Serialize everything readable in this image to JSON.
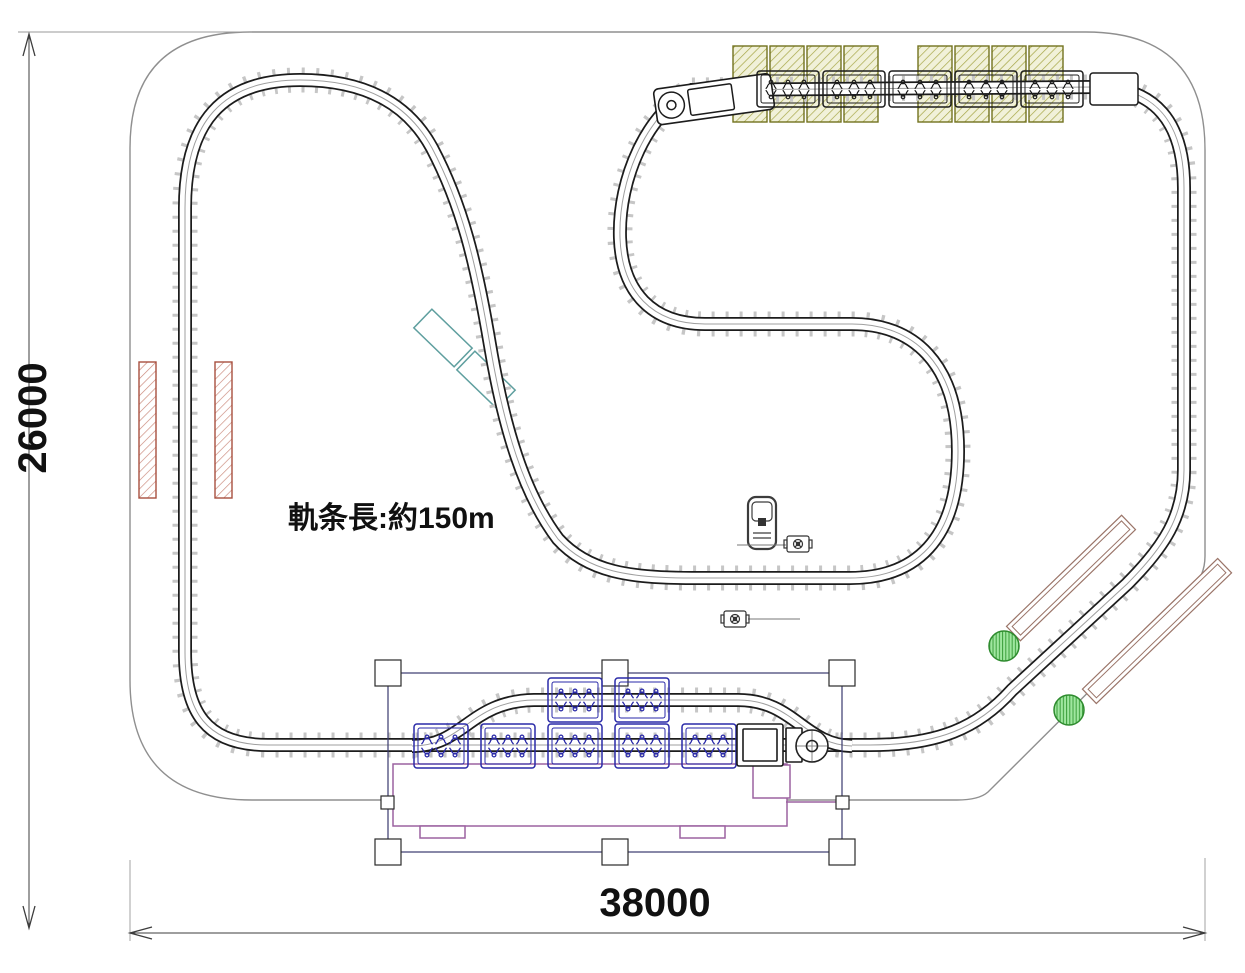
{
  "drawing": {
    "annotation": "軌条長:約150m",
    "dim_height": "26000",
    "dim_width": "38000"
  },
  "colors": {
    "track": "#1c1c1c",
    "tie": "#c6c6c6",
    "boundary": "#8f8f8f",
    "dim-line": "#3c3c3c",
    "dim-text": "#111111",
    "olive-outline": "#72721e",
    "olive-hatch": "#a6a647",
    "olive-bg": "#f1f1d9",
    "red-platform": "#a84f3f",
    "red-hatch": "#c98576",
    "teal": "#5f9f9f",
    "brown": "#9a7468",
    "green-outline": "#2e8b2e",
    "green-fill": "#9fe69f",
    "train-blue": "#2a2aa8",
    "train-dark": "#1c1c1c",
    "purple": "#9c62a0",
    "canopy": "#3a3a6e",
    "leader": "#777777"
  },
  "elements": {
    "top_station": {
      "platform_sections": 8,
      "train_cars": 5,
      "locomotive": 1
    },
    "bottom_station": {
      "train_cars_main": 5,
      "train_cars_siding": 2,
      "turntable": 1,
      "canopy_posts": 6
    },
    "left_platforms": 2,
    "right_sheds": 2,
    "trees": 2,
    "teal_structures": 2,
    "vehicle": 1,
    "equipment_markers": 2
  }
}
